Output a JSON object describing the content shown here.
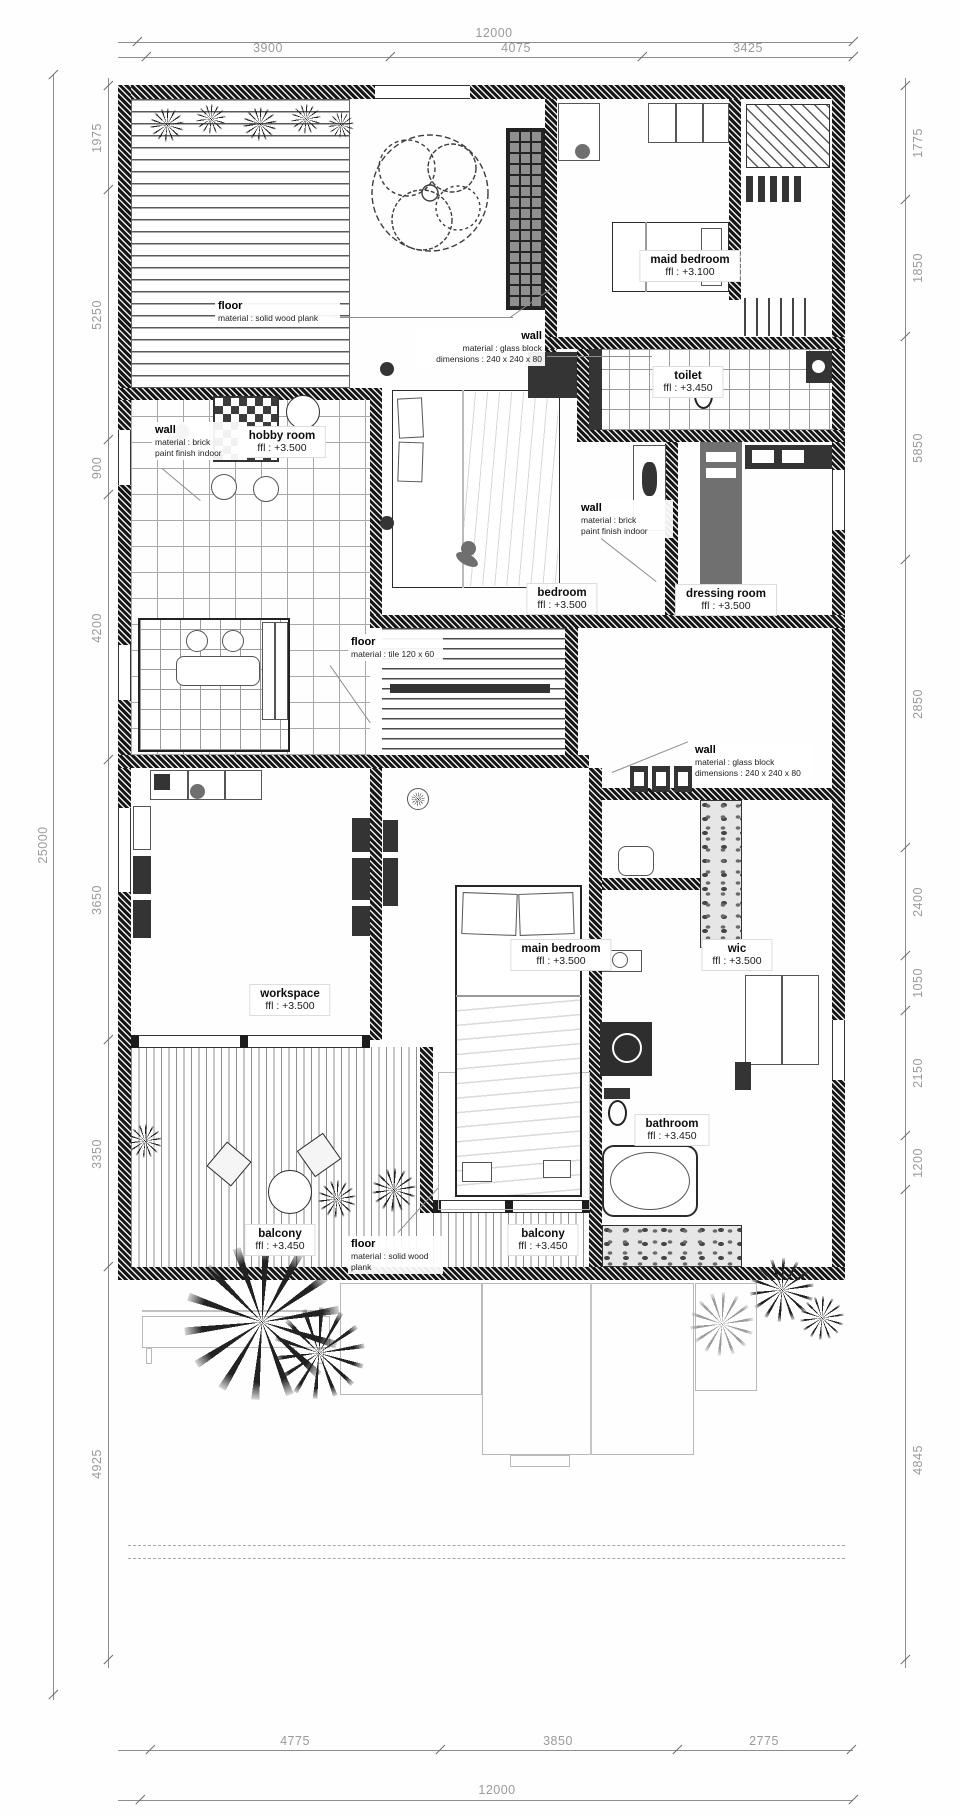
{
  "dims": {
    "top": {
      "overall": "12000",
      "segments": [
        "3900",
        "4075",
        "3425"
      ]
    },
    "bottom": {
      "overall": "12000",
      "segments": [
        "4775",
        "3850",
        "2775"
      ]
    },
    "left": {
      "overall": "25000",
      "segments": [
        "1975",
        "5250",
        "900",
        "4200",
        "3650",
        "3350",
        "4925"
      ]
    },
    "right": {
      "segments": [
        "1775",
        "1850",
        "5850",
        "2850",
        "2400",
        "1050",
        "2150",
        "1200",
        "4845"
      ]
    }
  },
  "rooms": {
    "maid_bedroom": {
      "name": "maid bedroom",
      "ffl": "ffl : +3.100"
    },
    "toilet": {
      "name": "toilet",
      "ffl": "ffl : +3.450"
    },
    "hobby_room": {
      "name": "hobby room",
      "ffl": "ffl : +3.500"
    },
    "bedroom": {
      "name": "bedroom",
      "ffl": "ffl : +3.500"
    },
    "dressing_room": {
      "name": "dressing room",
      "ffl": "ffl : +3.500"
    },
    "workspace": {
      "name": "workspace",
      "ffl": "ffl : +3.500"
    },
    "main_bedroom": {
      "name": "main bedroom",
      "ffl": "ffl : +3.500"
    },
    "wic": {
      "name": "wic",
      "ffl": "ffl : +3.500"
    },
    "bathroom": {
      "name": "bathroom",
      "ffl": "ffl : +3.450"
    },
    "balcony_left": {
      "name": "balcony",
      "ffl": "ffl : +3.450"
    },
    "balcony_center": {
      "name": "balcony",
      "ffl": "ffl : +3.450"
    }
  },
  "notes": {
    "floor_wood_top": {
      "title": "floor",
      "line1": "material : solid wood plank"
    },
    "wall_glass_top": {
      "title": "wall",
      "line1": "material : glass block",
      "line2": "dimensions : 240 x 240 x 80"
    },
    "wall_brick_hobby": {
      "title": "wall",
      "line1": "material : brick",
      "line2": "paint finish indoor"
    },
    "wall_brick_bedroom": {
      "title": "wall",
      "line1": "material : brick",
      "line2": "paint finish indoor"
    },
    "floor_tile": {
      "title": "floor",
      "line1": "material : tile 120 x 60"
    },
    "wall_glass_mid": {
      "title": "wall",
      "line1": "material : glass block",
      "line2": "dimensions : 240 x 240 x 80"
    },
    "floor_wood_bottom": {
      "title": "floor",
      "line1": "material : solid wood plank"
    }
  },
  "colors": {
    "wall": "#161616",
    "dimension_text": "#9a9a9a",
    "band_gray": "#707070"
  }
}
